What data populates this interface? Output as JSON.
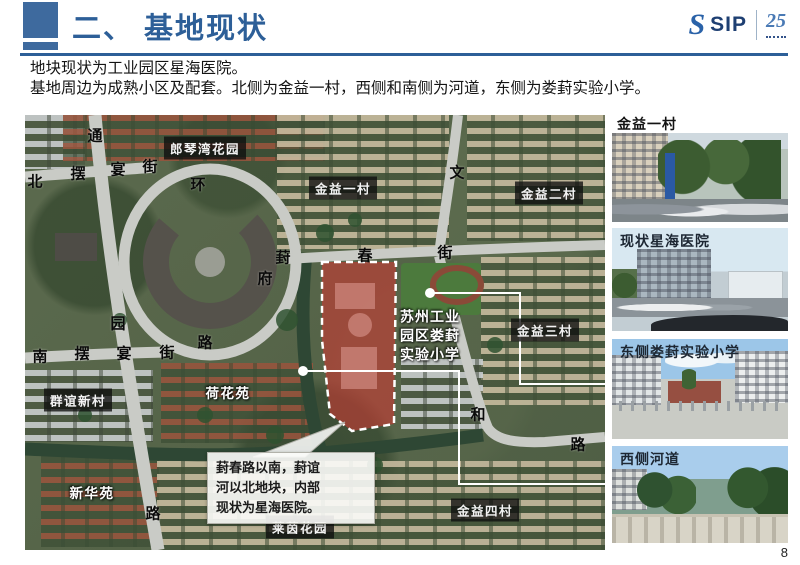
{
  "header": {
    "title": "二、 基地现状",
    "logo": {
      "brand": "SIP",
      "anniversary": "25"
    }
  },
  "intro": {
    "line1": "地块现状为工业园区星海医院。",
    "line2": "基地周边为成熟小区及配套。北侧为金益一村，西侧和南侧为河道，东侧为娄葑实验小学。"
  },
  "map": {
    "road_chars": {
      "tong": "通",
      "bei": "北",
      "bai1": "摆",
      "yan1": "宴",
      "jie1": "街",
      "huan": "环",
      "wen": "文",
      "feng": "葑",
      "chun": "春",
      "jie2": "街",
      "fu": "府",
      "yuan": "园",
      "lu1": "路",
      "nan": "南",
      "bai2": "摆",
      "yan2": "宴",
      "jie3": "街",
      "he": "和",
      "lu2": "路",
      "lu3": "路"
    },
    "boxed_labels": {
      "langqinwan": "郎琴湾花园",
      "jinyi1": "金益一村",
      "jinyi2": "金益二村",
      "jinyi3": "金益三村",
      "qunyi": "群谊新村",
      "jinyi4": "金益四村",
      "laiyin": "莱茵花园"
    },
    "plain_labels": {
      "hehua": "荷花苑",
      "xinhua": "新华苑"
    },
    "school_label": {
      "line1": "苏州工业",
      "line2": "园区娄葑",
      "line3": "实验小学"
    },
    "callout": {
      "line1": "葑春路以南，葑谊",
      "line2": "河以北地块，内部",
      "line3": "现状为星海医院。"
    }
  },
  "photos": {
    "p1": {
      "caption": "金益一村"
    },
    "p2": {
      "caption": "现状星海医院"
    },
    "p3": {
      "caption": "东侧娄葑实验小学"
    },
    "p4": {
      "caption": "西侧河道"
    }
  },
  "footer": {
    "page_number": "8"
  },
  "colors": {
    "accent": "#2d5f98",
    "site_fill": "#c23b35",
    "label_bg": "rgba(14,14,14,0.78)"
  }
}
